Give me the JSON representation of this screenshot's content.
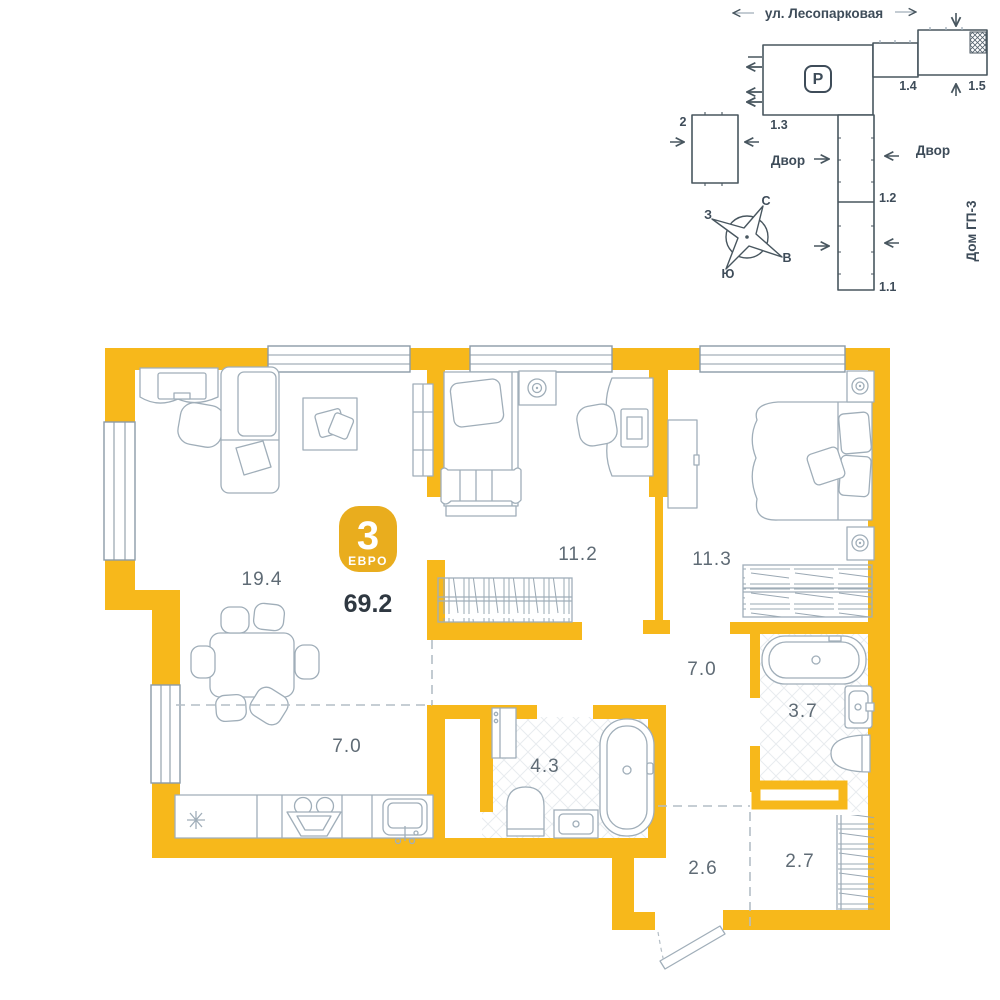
{
  "palette": {
    "wall_yellow": "#F7B81B",
    "badge_yellow": "#E9AD1E",
    "furniture_line": "#A0AEB9",
    "site_line": "#48565F",
    "room_text": "#5F6B75",
    "total_text": "#2F3841",
    "hatch_floor": "#E8ECEF"
  },
  "badge": {
    "rooms_count": "3",
    "format_label": "ЕВРО",
    "total_area": "69.2"
  },
  "rooms": [
    {
      "name": "living-room",
      "area": "19.4"
    },
    {
      "name": "bedroom-1",
      "area": "11.2"
    },
    {
      "name": "bedroom-2",
      "area": "11.3"
    },
    {
      "name": "hallway",
      "area": "7.0"
    },
    {
      "name": "bathroom",
      "area": "3.7"
    },
    {
      "name": "kitchen",
      "area": "7.0"
    },
    {
      "name": "bathroom-2",
      "area": "4.3"
    },
    {
      "name": "entry-hall",
      "area": "2.6"
    },
    {
      "name": "wardrobe",
      "area": "2.7"
    }
  ],
  "site_plan": {
    "street": "ул. Лесопарковая",
    "parking_label": "P",
    "courtyard_left": "Двор",
    "courtyard_right": "Двор",
    "neighbor_house": "Дом ГП-3",
    "buildings": [
      {
        "label": "2"
      },
      {
        "label": "1.3"
      },
      {
        "label": "1.4"
      },
      {
        "label": "1.5"
      },
      {
        "label": "1.2"
      },
      {
        "label": "1.1"
      }
    ],
    "compass": {
      "north": "С",
      "south": "Ю",
      "west": "З",
      "east": "В"
    }
  }
}
